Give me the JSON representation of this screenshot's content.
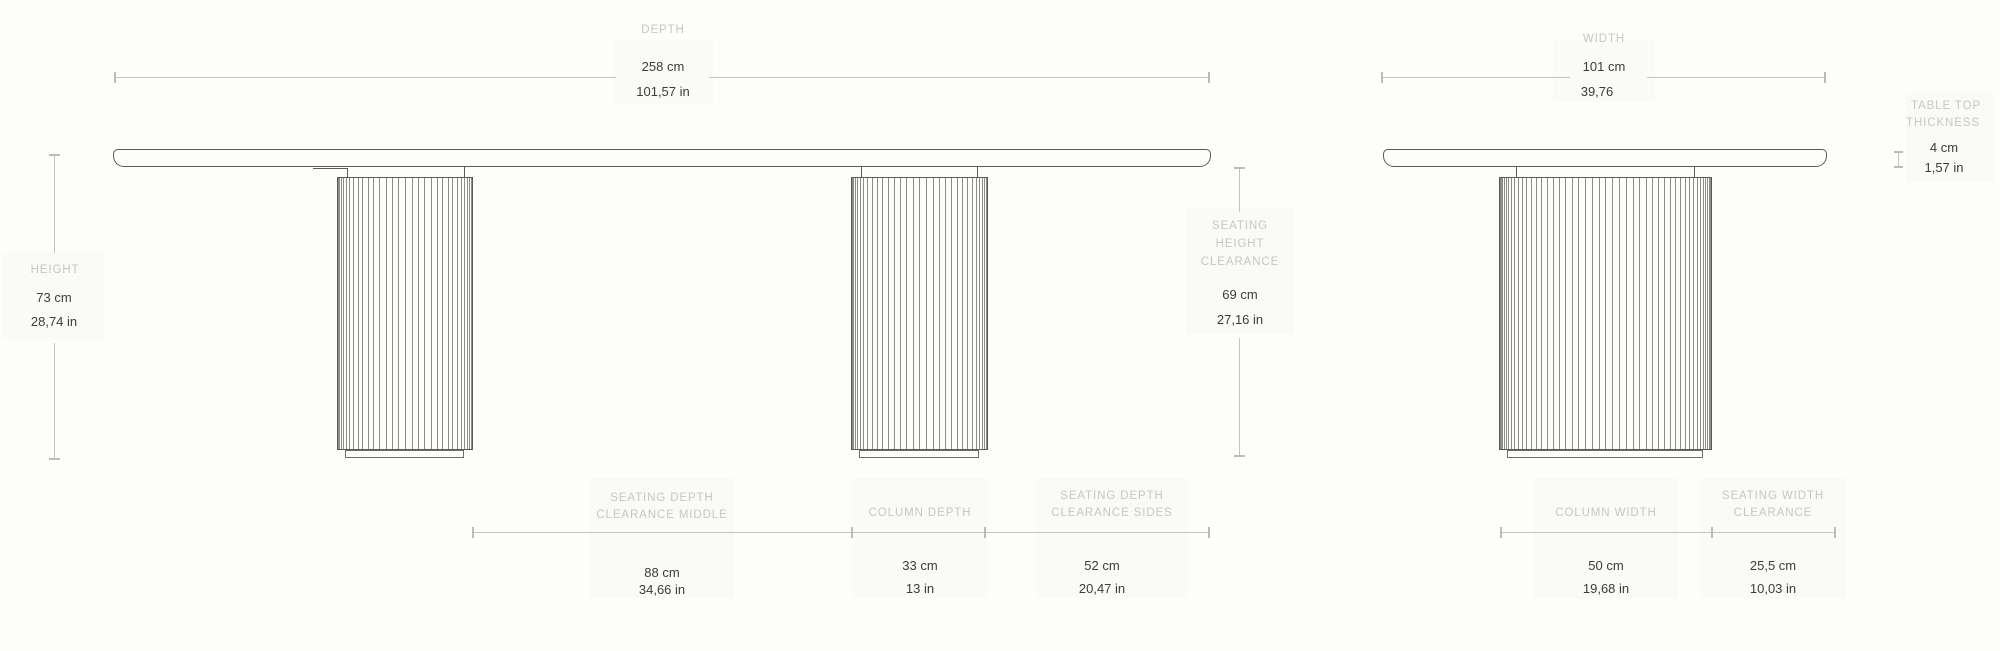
{
  "side_view": {
    "depth": {
      "label": "DEPTH",
      "cm": "258 cm",
      "in": "101,57 in"
    },
    "height": {
      "label": "HEIGHT",
      "cm": "73 cm",
      "in": "28,74 in"
    },
    "seating_height_clearance": {
      "label_lines": [
        "SEATING",
        "HEIGHT",
        "CLEARANCE"
      ],
      "cm": "69 cm",
      "in": "27,16 in"
    },
    "seating_depth_clearance_middle": {
      "label_lines": [
        "SEATING DEPTH",
        "CLEARANCE MIDDLE"
      ],
      "cm": "88 cm",
      "in": "34,66 in"
    },
    "column_depth": {
      "label": "COLUMN DEPTH",
      "cm": "33 cm",
      "in": "13 in"
    },
    "seating_depth_clearance_sides": {
      "label_lines": [
        "SEATING DEPTH",
        "CLEARANCE SIDES"
      ],
      "cm": "52 cm",
      "in": "20,47 in"
    }
  },
  "front_view": {
    "width": {
      "label": "WIDTH",
      "cm": "101 cm",
      "in": "39,76"
    },
    "table_top_thickness": {
      "label_lines": [
        "TABLE TOP",
        "THICKNESS"
      ],
      "cm": "4 cm",
      "in": "1,57 in"
    },
    "column_width": {
      "label": "COLUMN WIDTH",
      "cm": "50 cm",
      "in": "19,68 in"
    },
    "seating_width_clearance": {
      "label_lines": [
        "SEATING WIDTH",
        "CLEARANCE"
      ],
      "cm": "25,5 cm",
      "in": "10,03 in"
    }
  },
  "colors": {
    "background": "#fdfdfc",
    "label_text": "#c8c6c3",
    "value_text": "#3d3c3a",
    "dimension_line": "#c6c4c1",
    "drawing_outline": "#5c5a56"
  }
}
